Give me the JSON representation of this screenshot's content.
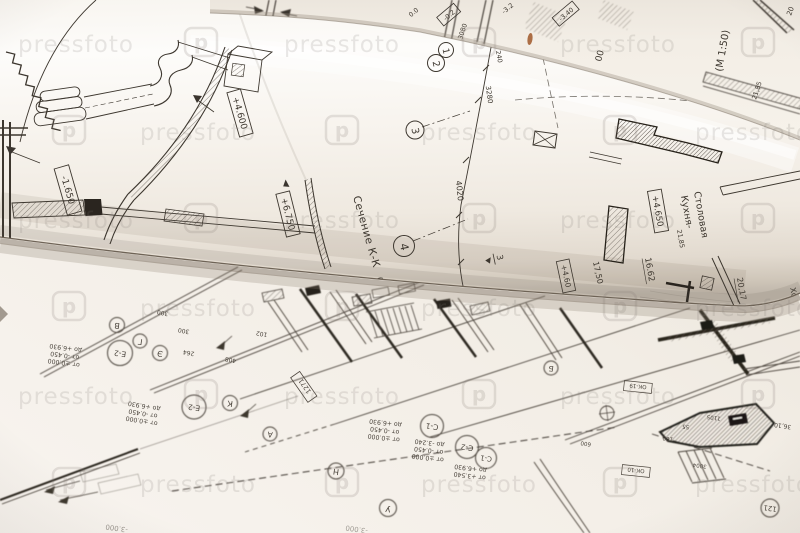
{
  "photo": {
    "subject": "architectural blueprint rolls on floor plan",
    "paper_color": "#f4efe8",
    "line_color": "#3d372f",
    "shadow_color": "#8d8276",
    "speck_color": "#a45f33"
  },
  "watermark": {
    "text": "pressfoto",
    "logo_letter": "p"
  },
  "back_sheet": {
    "elev_a": "0.0",
    "elev_b": "-0.2",
    "elev_c": "-3.2",
    "elev_d": "-3.40",
    "dim_3080": "3080",
    "dim_00": "00",
    "dim_20": "20",
    "dim_2185": "21,85",
    "scale_label": "(М 1:50)"
  },
  "left_sheet": {
    "elev_4600": "+4.600",
    "elev_1650": "-1.650",
    "elev_6750": "+6.750"
  },
  "roll": {
    "section_label": "Сечение К-К",
    "section_scale": "(М 1:5",
    "bubble_1": "1",
    "bubble_2": "2",
    "bubble_3": "3",
    "bubble_4": "4",
    "dim_240": "240",
    "dim_3280": "3280",
    "dim_4020": "4020",
    "marker_3": "3",
    "room_line1": "Кухня-",
    "room_line2": "Столовая",
    "elev_4650": "+4.650",
    "elev_460": "+4.60",
    "area_1662": "16.62",
    "area_1750": "17,50",
    "area_2017": "20,17",
    "area_2185": "21,85",
    "hall_label": "Хол"
  },
  "plan_sheet": {
    "bubble_v": "В",
    "bubble_g": "Г",
    "bubble_e2": "Е-2",
    "bubble_e": "Э",
    "bubble_k": "К",
    "bubble_e2b": "Е-2",
    "bubble_a": "А",
    "bubble_n": "Н",
    "bubble_u": "У",
    "bubble_b": "Б",
    "bubble_c1": "С-1",
    "bubble_c2": "С-2",
    "bubble_c1b": "С-1",
    "bubble_121": "121",
    "dim_300a": "300",
    "dim_300b": "300",
    "dim_264": "264",
    "dim_408": "408",
    "dim_102": "102",
    "dim_1271": "1271",
    "elev_block1": [
      "от ±0.000",
      "от -0.450",
      "до +6.930"
    ],
    "elev_block2": [
      "от ±0.000",
      "от -0.450",
      "до +6.930"
    ],
    "elev_block3": [
      "от ±0.000",
      "от -0.450",
      "до +6.930"
    ],
    "elev_block4": [
      "от ±0.000",
      "от -0.450",
      "до -3.240"
    ],
    "elev_block5": [
      "от +3.540",
      "до +6.930"
    ],
    "label_ok1": "ОК-19",
    "label_ok2": "ОК-10",
    "dim_100": "100",
    "dim_55": "55",
    "dim_1105": "1105",
    "dim_600": "600",
    "dim_3004": "3004",
    "area_3610": "36,10",
    "elev_3000a": "-3.000",
    "elev_3000b": "-3.000"
  }
}
